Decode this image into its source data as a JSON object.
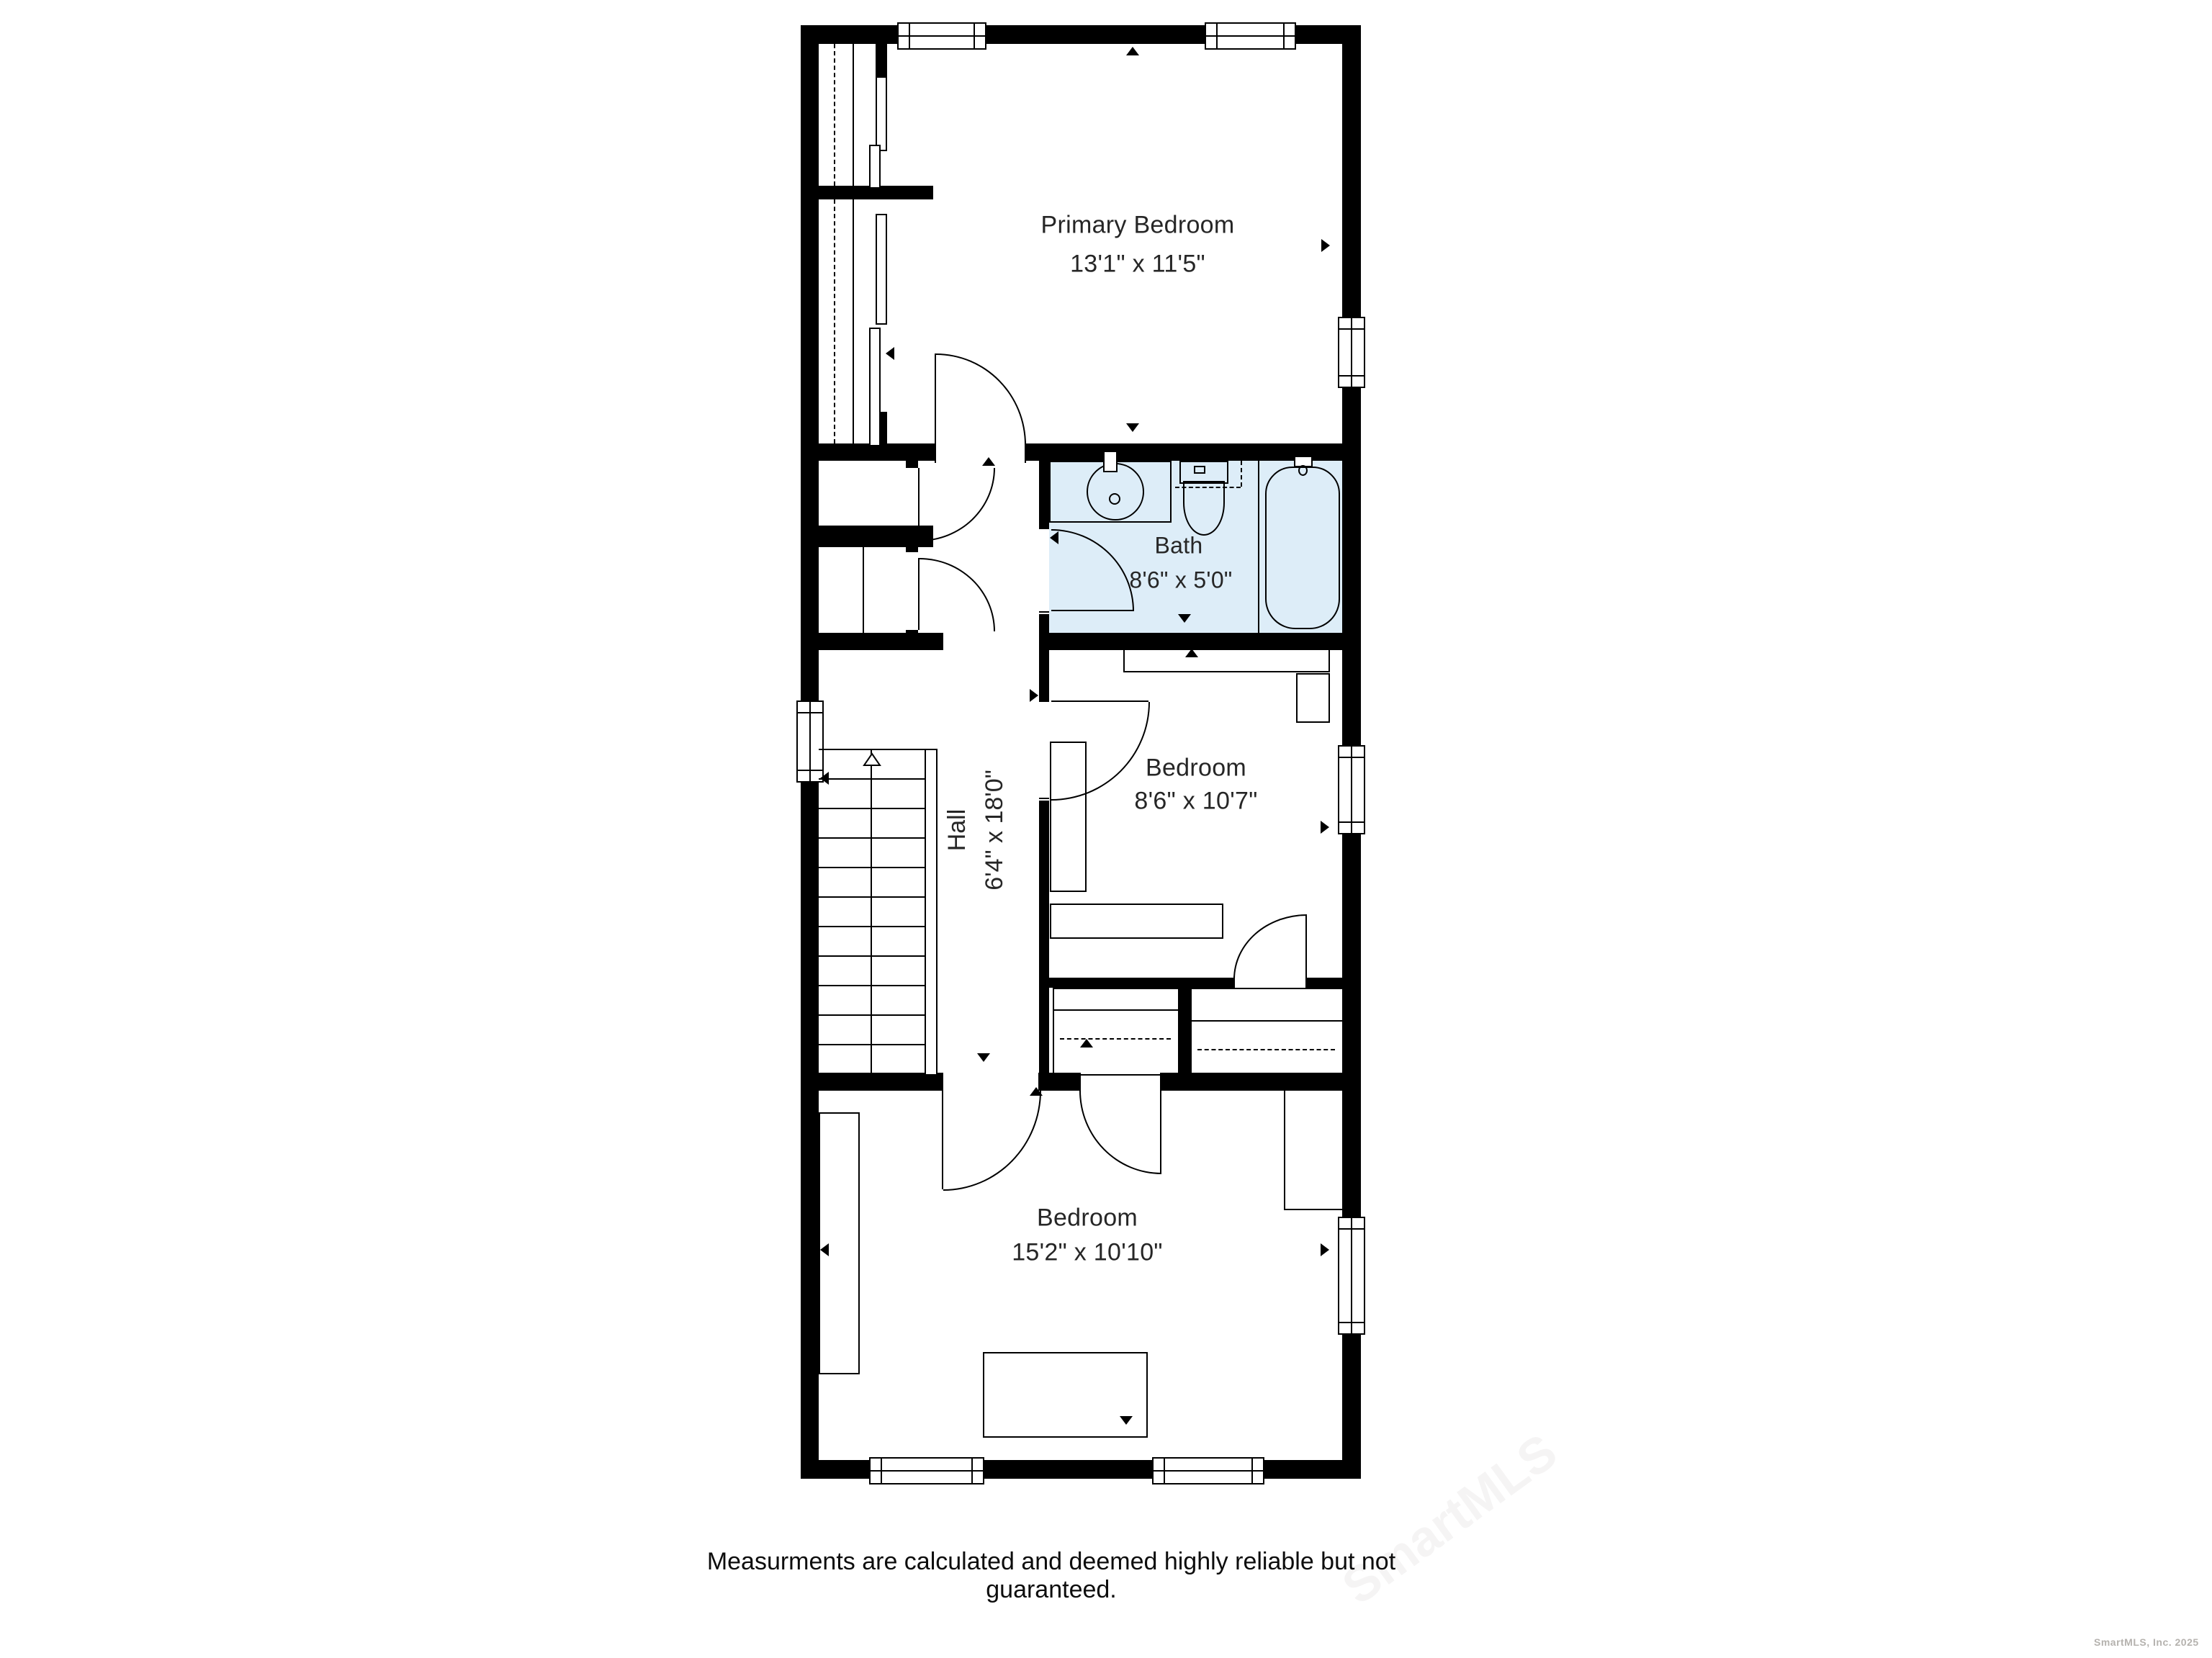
{
  "plan": {
    "rooms": [
      {
        "id": "primary-bedroom",
        "name": "Primary Bedroom",
        "dims": "13'1\" x 11'5\""
      },
      {
        "id": "bath",
        "name": "Bath",
        "dims": "8'6\" x 5'0\""
      },
      {
        "id": "hall",
        "name": "Hall",
        "dims": "6'4\" x 18'0\""
      },
      {
        "id": "bedroom-middle",
        "name": "Bedroom",
        "dims": "8'6\" x 10'7\""
      },
      {
        "id": "bedroom-bottom",
        "name": "Bedroom",
        "dims": "15'2\" x 10'10\""
      }
    ],
    "colors": {
      "wall": "#000000",
      "bath_fill": "#ddedf8",
      "page_bg": "#ffffff",
      "label_text": "#262626"
    },
    "icons": [
      "sink-icon",
      "toilet-icon",
      "bathtub-icon",
      "stairs-icon",
      "window-icon",
      "door-swing-icon",
      "closet-rod-dashed-line",
      "direction-arrow-icon",
      "stairs-up-arrow-icon"
    ]
  },
  "footer": {
    "disclaimer": "Measurments are calculated and deemed highly reliable but not guaranteed."
  },
  "watermark": {
    "credit": "SmartMLS, Inc.  2025",
    "diagonal": "SmartMLS"
  }
}
